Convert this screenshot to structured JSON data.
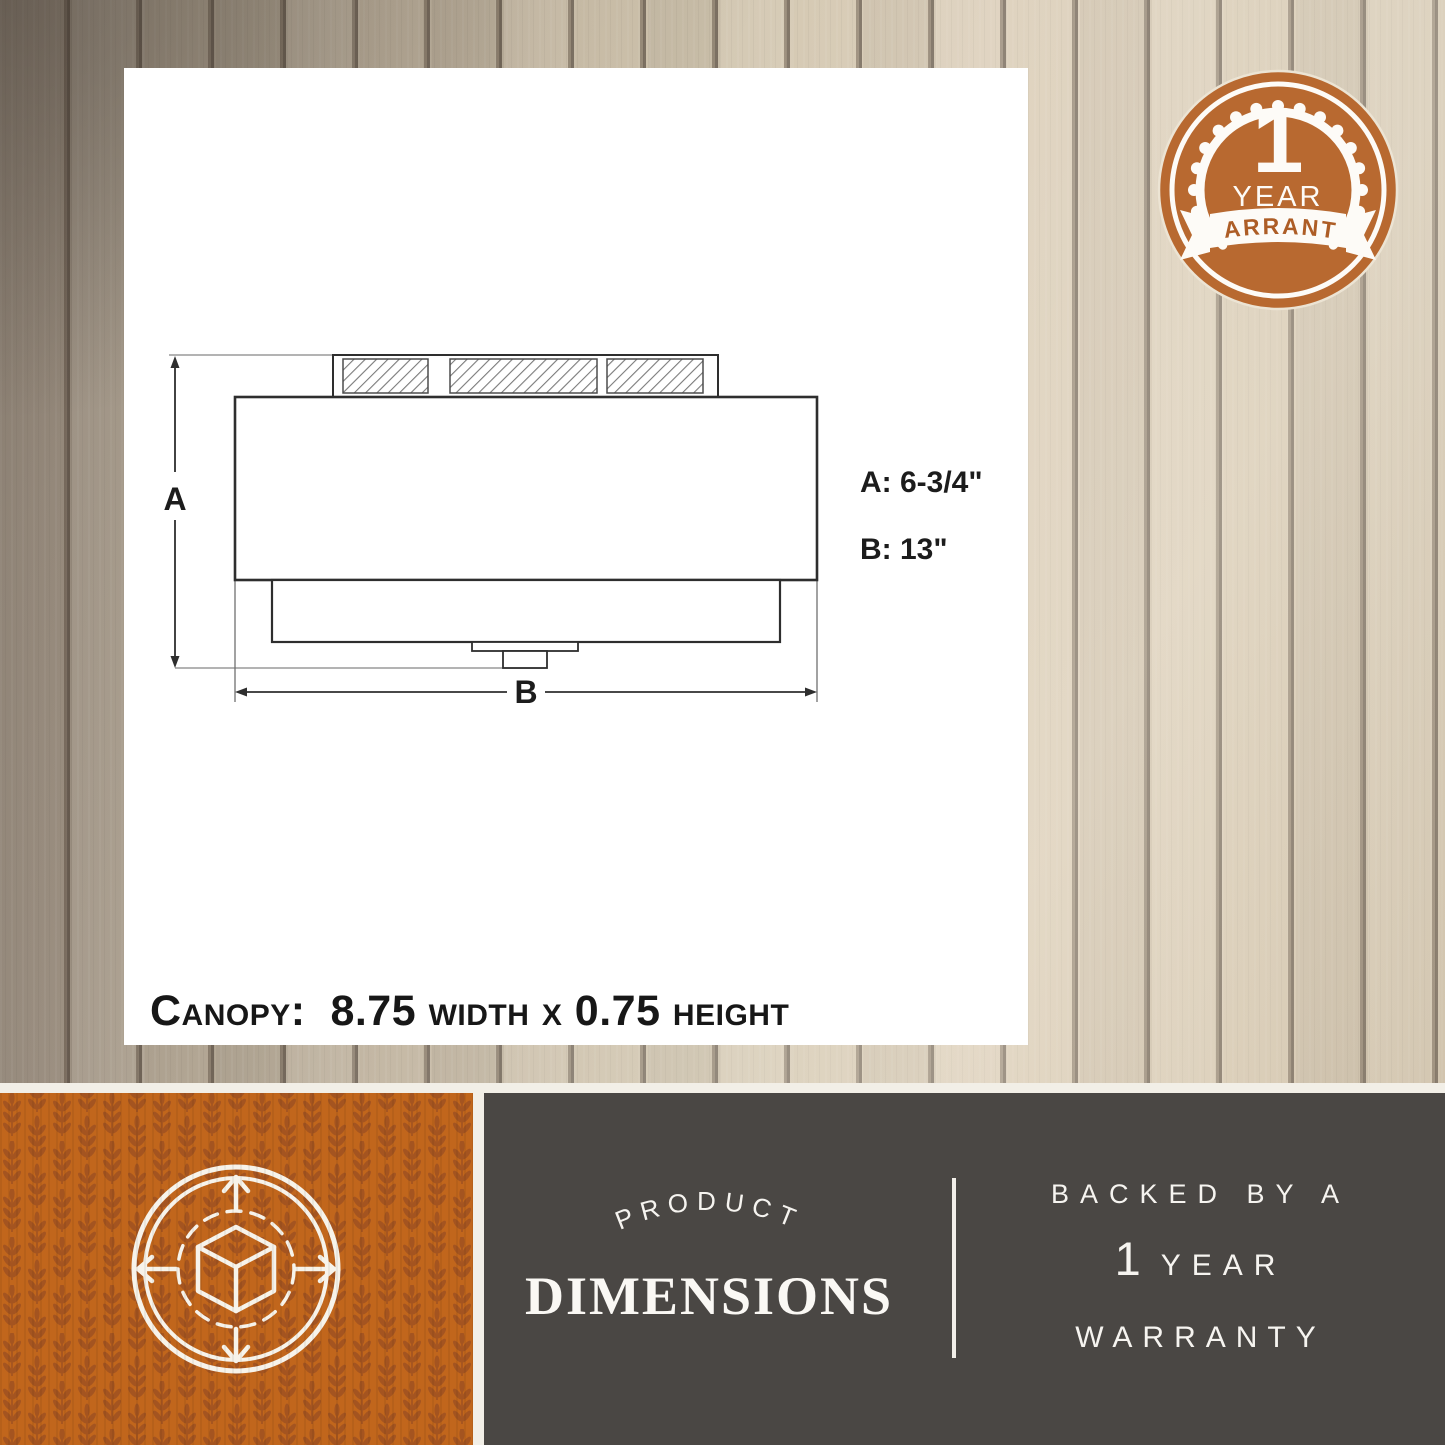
{
  "meta": {
    "type": "product-dimensions-infographic"
  },
  "colors": {
    "accent_orange": "#c1661c",
    "badge_orange": "#b86930",
    "panel_dark": "#4a4744",
    "card_white": "#ffffff",
    "cream_separator": "#f2efe7",
    "drawing_line": "#2e2e2e"
  },
  "warranty_badge": {
    "number": "1",
    "year_label": "YEAR",
    "ribbon_label": "WARRANTY"
  },
  "diagram": {
    "dim_a_letter": "A",
    "dim_b_letter": "B",
    "dim_a_value": "A: 6-3/4\"",
    "dim_b_value": "B: 13\"",
    "canopy_note": "Canopy:  8.75 width x 0.75 height"
  },
  "footer": {
    "left_icon": "cube-expand-arrows-icon",
    "arched_label": "PRODUCT",
    "main_label": "DIMENSIONS",
    "right": {
      "line1": "BACKED BY A",
      "line2_number": "1",
      "line2_word": "YEAR",
      "line3": "WARRANTY"
    }
  }
}
